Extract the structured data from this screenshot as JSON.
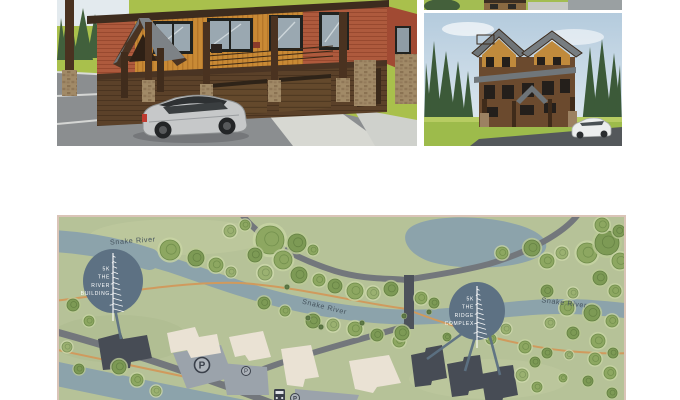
{
  "page": {
    "background": "#ffffff"
  },
  "panels": {
    "hero": {
      "name": "river-building-closeup-rendering"
    },
    "thumb_top": {
      "name": "cropped-rendering-strip"
    },
    "thumb_bottom": {
      "name": "ridge-complex-rendering"
    }
  },
  "map": {
    "colors": {
      "bg": "#b6c298",
      "border": "#dac4b7",
      "water": "#8ca3ab",
      "road": "#73777c",
      "bridge": "#4d525b",
      "trail": "#d09a5d",
      "lot": "#9ba3ab",
      "building_dark": "#474c55",
      "building_cream": "#eae2d4",
      "marker": "#5d7183",
      "marker_text": "#ffffff",
      "label": "#45535d",
      "icon_dark": "#3a404a",
      "icon_fill": "#adb3ba"
    },
    "tree_palette": [
      {
        "fill": "#8da761",
        "stroke": "#6f8c4a",
        "halo": "#c8d4a4"
      },
      {
        "fill": "#7d9a55",
        "stroke": "#637f42",
        "halo": "#bccb96"
      },
      {
        "fill": "#9bb171",
        "stroke": "#7b935a",
        "halo": "#d0daad"
      },
      {
        "fill": "#5f7b47",
        "stroke": "#4e663a",
        "halo": "#9fb37e"
      }
    ],
    "river_labels": [
      {
        "text": "Snake River",
        "x": 74,
        "y": 26,
        "rot": -4
      },
      {
        "text": "Snake River",
        "x": 265,
        "y": 92,
        "rot": 14
      },
      {
        "text": "Snake River",
        "x": 505,
        "y": 88,
        "rot": 7
      }
    ],
    "markers": [
      {
        "id": "the-river-building",
        "label_lines": [
          "5K",
          "THE",
          "RIVER",
          "BUILDING"
        ],
        "cx": 54,
        "cy": 64,
        "rx": 30,
        "ry": 32,
        "leaders": [
          [
            56,
            92,
            62,
            122
          ]
        ]
      },
      {
        "id": "the-ridge-complex",
        "label_lines": [
          "5K",
          "THE",
          "RIDGE",
          "COMPLEX"
        ],
        "cx": 418,
        "cy": 94,
        "rx": 28,
        "ry": 29,
        "leaders": [
          [
            404,
            116,
            368,
            142
          ],
          [
            416,
            120,
            406,
            154
          ],
          [
            430,
            116,
            441,
            158
          ]
        ]
      }
    ],
    "parking": [
      {
        "letter": "P",
        "x": 143,
        "y": 148,
        "r": 7.5,
        "fs": 10,
        "w": "bold"
      },
      {
        "letter": "P",
        "x": 187,
        "y": 154,
        "r": 4.5,
        "fs": 6,
        "w": "normal"
      }
    ],
    "trees": [
      [
        211,
        23,
        14,
        0
      ],
      [
        238,
        26,
        9,
        1
      ],
      [
        254,
        33,
        5,
        0
      ],
      [
        196,
        38,
        7,
        1
      ],
      [
        224,
        43,
        9,
        0
      ],
      [
        206,
        56,
        7,
        2
      ],
      [
        240,
        58,
        8,
        1
      ],
      [
        260,
        63,
        6,
        0
      ],
      [
        276,
        69,
        7,
        1
      ],
      [
        296,
        74,
        8,
        0
      ],
      [
        314,
        76,
        6,
        2
      ],
      [
        332,
        72,
        7,
        1
      ],
      [
        362,
        81,
        6,
        0
      ],
      [
        375,
        86,
        5,
        1
      ],
      [
        171,
        14,
        6,
        2
      ],
      [
        186,
        8,
        5,
        0
      ],
      [
        111,
        33,
        10,
        0
      ],
      [
        137,
        41,
        8,
        1
      ],
      [
        157,
        48,
        7,
        0
      ],
      [
        172,
        55,
        5,
        2
      ],
      [
        14,
        88,
        6,
        1
      ],
      [
        30,
        104,
        5,
        0
      ],
      [
        8,
        130,
        5,
        2
      ],
      [
        60,
        150,
        7,
        1
      ],
      [
        78,
        163,
        6,
        0
      ],
      [
        20,
        152,
        5,
        1
      ],
      [
        97,
        174,
        5,
        2
      ],
      [
        205,
        86,
        6,
        1
      ],
      [
        226,
        94,
        5,
        0
      ],
      [
        254,
        104,
        7,
        1
      ],
      [
        274,
        108,
        6,
        2
      ],
      [
        296,
        112,
        7,
        0
      ],
      [
        318,
        118,
        6,
        1
      ],
      [
        340,
        124,
        6,
        0
      ],
      [
        343,
        116,
        7,
        1
      ],
      [
        443,
        36,
        6,
        0
      ],
      [
        473,
        31,
        8,
        1
      ],
      [
        488,
        44,
        7,
        0
      ],
      [
        503,
        36,
        6,
        2
      ],
      [
        528,
        36,
        10,
        0
      ],
      [
        548,
        26,
        12,
        1
      ],
      [
        561,
        44,
        8,
        0
      ],
      [
        541,
        61,
        7,
        1
      ],
      [
        556,
        74,
        6,
        0
      ],
      [
        514,
        76,
        5,
        2
      ],
      [
        488,
        74,
        6,
        1
      ],
      [
        508,
        91,
        7,
        0
      ],
      [
        533,
        96,
        8,
        1
      ],
      [
        553,
        104,
        6,
        0
      ],
      [
        491,
        106,
        5,
        2
      ],
      [
        514,
        116,
        6,
        1
      ],
      [
        539,
        124,
        7,
        0
      ],
      [
        554,
        136,
        5,
        1
      ],
      [
        536,
        142,
        6,
        0
      ],
      [
        510,
        138,
        4,
        2
      ],
      [
        488,
        136,
        5,
        1
      ],
      [
        551,
        156,
        6,
        0
      ],
      [
        529,
        164,
        5,
        1
      ],
      [
        504,
        161,
        4,
        0
      ],
      [
        553,
        176,
        5,
        1
      ],
      [
        466,
        130,
        6,
        0
      ],
      [
        476,
        145,
        5,
        1
      ],
      [
        463,
        158,
        6,
        2
      ],
      [
        478,
        170,
        5,
        0
      ],
      [
        388,
        120,
        4,
        1
      ],
      [
        432,
        122,
        5,
        0
      ],
      [
        447,
        112,
        5,
        2
      ],
      [
        543,
        8,
        7,
        0
      ],
      [
        560,
        14,
        6,
        1
      ],
      [
        249,
        101,
        2,
        3
      ],
      [
        262,
        110,
        2,
        3
      ],
      [
        303,
        106,
        2,
        3
      ],
      [
        345,
        99,
        2,
        3
      ],
      [
        370,
        95,
        2,
        3
      ],
      [
        228,
        70,
        2,
        3
      ]
    ],
    "dark_buildings": [
      "39,122 62,116 64,122 88,118 93,141 72,145 71,151 44,153",
      "352,138 366,135 367,131 383,128 388,161 373,164 372,168 356,170",
      "388,147 404,144 405,140 421,138 426,171 410,174 409,178 393,180",
      "422,157 438,154 439,150 454,148 459,178 444,181 443,185 427,187"
    ],
    "cream_buildings": [
      "108,116 136,110 140,120 158,117 162,136 132,141 128,133 112,136",
      "170,120 204,114 212,140 190,144 186,138 176,140",
      "222,132 252,128 260,160 246,162 244,170 228,168",
      "290,144 330,138 342,166 318,170 314,176 296,172"
    ],
    "parking_lots": [
      "114,136 162,128 174,160 128,172",
      "162,146 208,150 210,178 168,178",
      "236,172 300,178 298,183 236,183"
    ]
  }
}
